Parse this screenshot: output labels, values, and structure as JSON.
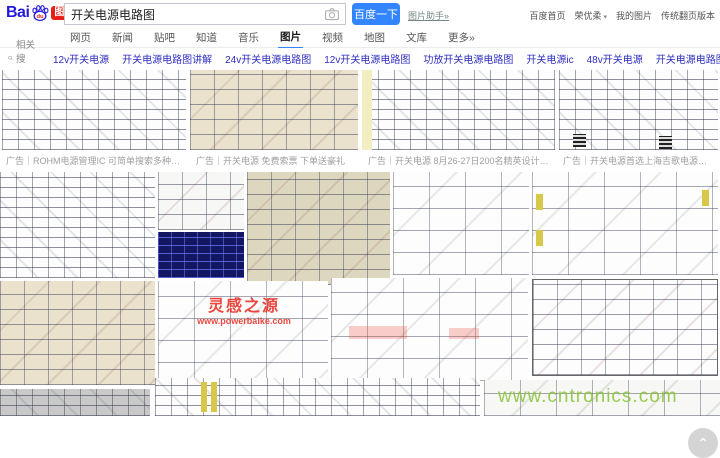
{
  "header": {
    "logo": {
      "bai": "Bai",
      "du": "du",
      "badge": "图片"
    },
    "search": {
      "value": "开关电源电路图",
      "button_label": "百度一下",
      "helper_link": "图片助手»"
    },
    "top_links": [
      "百度首页",
      "荣优柔",
      "我的图片",
      "传统翻页版本"
    ]
  },
  "tabs": [
    "网页",
    "新闻",
    "贴吧",
    "知道",
    "音乐",
    "图片",
    "视频",
    "地图",
    "文库",
    "更多»"
  ],
  "active_tab": "图片",
  "related": {
    "label": "相关搜索：",
    "terms": [
      "12v开关电源",
      "开关电源电路图讲解",
      "24v开关电源电路图",
      "12v开关电源电路图",
      "功放开关电源电路图",
      "开关电源ic",
      "48v开关电源",
      "开关电源电路图详解",
      "380v开关电源电路图"
    ]
  },
  "results": {
    "ad_captions": [
      "广告｜ROHM电源管理IC 可简单搜索多种产品线!",
      "广告｜开关电源 免费索票 下单送豪礼",
      "广告｜开关电源 8月26-27日200名精英设计师等..",
      "广告｜开关电源首选上海吉歌电源科技有..."
    ],
    "watermarks": {
      "powerbaike_title": "灵感之源",
      "powerbaike_url": "www.powerbaike.com",
      "cntronics": "www.cntronics.com"
    },
    "back_to_top": "⌃"
  },
  "colors": {
    "baidu_blue": "#2319dc",
    "button_blue": "#3385ff",
    "badge_red": "#e71f19",
    "related_link_blue": "#2d2dbe",
    "active_tab_underline": "#3385ff",
    "watermark_red": "#e8281e",
    "watermark_green": "#8dc63f"
  }
}
